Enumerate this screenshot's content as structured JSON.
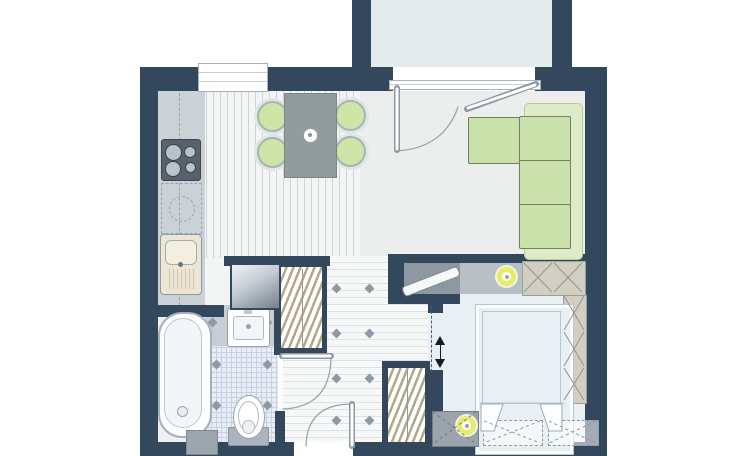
{
  "meta": {
    "type": "apartment floor plan",
    "text_on_image": ""
  },
  "colors": {
    "wall": "#33475d",
    "balconyFloor": "#e3ebeb",
    "kitchenFloor": "#f3f5f5",
    "kitchenStripe": "#cdd5d8",
    "livingFloor": "#eceeed",
    "hallFloor": "#f7f8f8",
    "hallStripe": "#dde2e4",
    "bathFloorLeft": "#eef1f2",
    "bathTile": "#e9edf6",
    "bathGrid": "#c7d1e2",
    "grayTile": "#c6cdd5",
    "counter": "#cbd2d7",
    "stove": "#57626c",
    "burner": "#bac3c9",
    "sink": "#ede6d4",
    "hanger": "#b3a88a",
    "xFill": "#d2cfc2",
    "xLine": "#8f9792",
    "sofaSeat": "#cbe1ab",
    "sofaBack": "#ddecc6",
    "sofaLine": "#71815f",
    "table": "#919c9b",
    "chairSeat": "#cfe5a8",
    "chairRing": "#e0e5e5",
    "consoleDark": "#8e98a0",
    "consoleLight": "#b8c0c6",
    "lamp": "#e8eb6e",
    "bedFill": "#e8f0f4",
    "bedLine": "#bac5cd",
    "nightstand": "#9ba4ac",
    "cistern": "#abb4bd",
    "line": "#98a3ad",
    "door": "#8a95a0",
    "diamond": "#8e99a6",
    "dark": "#16191d"
  },
  "rooms": [
    {
      "id": "balcony",
      "label": "balcony"
    },
    {
      "id": "kitchen",
      "label": "kitchen with dining area"
    },
    {
      "id": "living-area",
      "label": "living area"
    },
    {
      "id": "hallway",
      "label": "hallway"
    },
    {
      "id": "bathroom",
      "label": "bathroom"
    },
    {
      "id": "bedroom",
      "label": "bedroom"
    }
  ],
  "furniture": [
    {
      "room": "kitchen",
      "items": [
        "counter run",
        "4-burner stove",
        "sink with drainboard",
        "planned appliance (dashed)",
        "fridge",
        "dining table",
        "4 chairs with green seats"
      ]
    },
    {
      "room": "living-area",
      "items": [
        "L-shaped green corner sofa",
        "TV on media stand",
        "round lamp",
        "cross-hatched storage cabinet"
      ]
    },
    {
      "room": "hallway",
      "items": [
        "open wardrobe with hangers (upper)",
        "open wardrobe with hangers (lower)"
      ]
    },
    {
      "room": "bathroom",
      "items": [
        "bathtub",
        "washbasin",
        "toilet with cistern",
        "utility block"
      ]
    },
    {
      "room": "bedroom",
      "items": [
        "double bed with two pillows",
        "nightstand with round lamp",
        "two dashed under-bed storage boxes",
        "cross-hatched wardrobe column"
      ]
    }
  ],
  "openings": [
    {
      "id": "kitchen-window",
      "label": "window over kitchen"
    },
    {
      "id": "balcony-door",
      "label": "glazed balcony door with swing arc"
    },
    {
      "id": "bathroom-door",
      "label": "bathroom door with swing arc"
    },
    {
      "id": "entry-door",
      "label": "apartment entry door with swing arc"
    },
    {
      "id": "bedroom-sliding-door",
      "label": "bedroom sliding door (double arrow)"
    }
  ]
}
